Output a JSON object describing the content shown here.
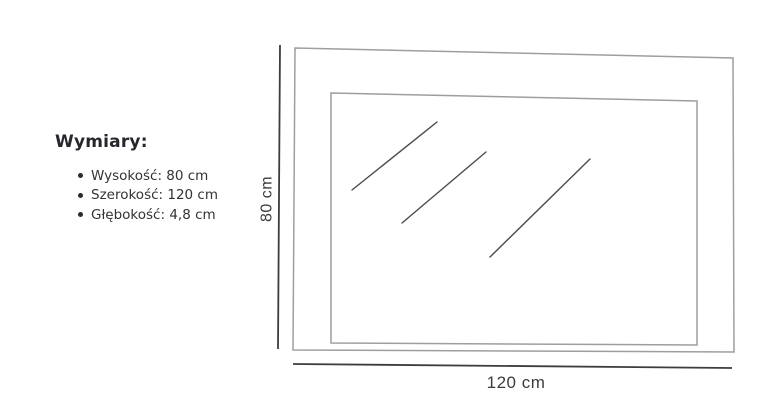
{
  "dimensions_panel": {
    "heading": "Wymiary:",
    "items": [
      {
        "label": "Wysokość: 80 cm"
      },
      {
        "label": "Szerokość: 120 cm"
      },
      {
        "label": "Głębokość: 4,8 cm"
      }
    ]
  },
  "diagram": {
    "height_label": "80 cm",
    "width_label": "120 cm",
    "reflection_line_count": 3
  },
  "colors": {
    "background": "#ffffff",
    "frame_stroke": "#9e9e9e",
    "reflection_stroke": "#4b4b4f",
    "dimension_stroke": "#3d3d3d",
    "dimension_text": "#3c3c3c",
    "heading_text": "#26262c",
    "body_text": "#333333"
  }
}
